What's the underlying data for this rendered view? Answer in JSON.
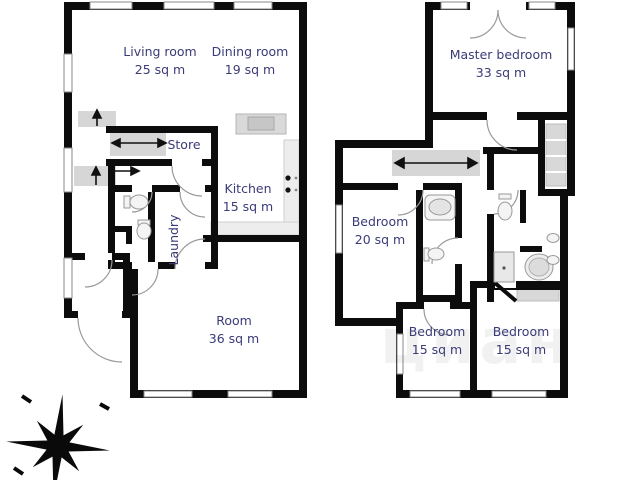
{
  "colors": {
    "wall": "#0c0c0c",
    "room_label": "#3b3b78",
    "stairs_fill": "#d6d6d6",
    "closet_fill": "#d8d8d8",
    "counter_fill": "#ededed"
  },
  "floors": {
    "ground": {
      "rooms": {
        "living": {
          "name": "Living room",
          "area": "25 sq m"
        },
        "dining": {
          "name": "Dining room",
          "area": "19 sq m"
        },
        "store": {
          "name": "Store"
        },
        "kitchen": {
          "name": "Kitchen",
          "area": "15 sq m"
        },
        "laundry": {
          "name": "Laundry"
        },
        "room": {
          "name": "Room",
          "area": "36 sq m"
        }
      }
    },
    "upper": {
      "rooms": {
        "master": {
          "name": "Master bedroom",
          "area": "33 sq m"
        },
        "bedroom_a": {
          "name": "Bedroom",
          "area": "20 sq m"
        },
        "bedroom_b": {
          "name": "Bedroom",
          "area": "15 sq m"
        },
        "bedroom_c": {
          "name": "Bedroom",
          "area": "15 sq m"
        }
      }
    }
  },
  "watermark": "циан"
}
